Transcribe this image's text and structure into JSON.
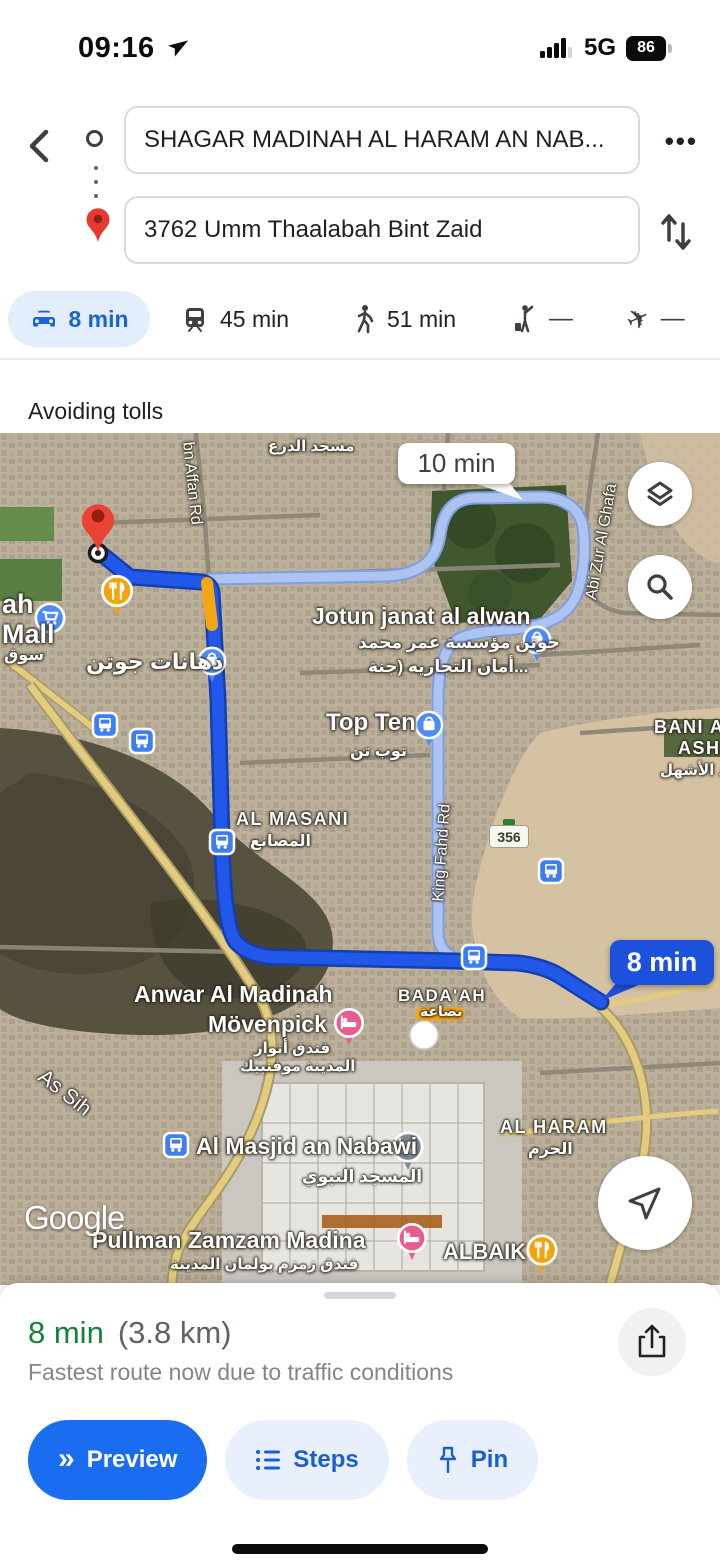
{
  "status_bar": {
    "time": "09:16",
    "network": "5G",
    "battery_percent": "86"
  },
  "nav": {
    "origin_value": "SHAGAR MADINAH AL HARAM AN NAB...",
    "destination_value": "3762 Umm Thaalabah Bint Zaid"
  },
  "icons": {
    "more_ellipsis": "•••",
    "preview_chevrons": "»",
    "plane_glyph": "✈"
  },
  "modes": [
    {
      "key": "drive",
      "time": "8 min",
      "selected": true
    },
    {
      "key": "transit",
      "time": "45 min",
      "selected": false
    },
    {
      "key": "walking",
      "time": "51 min",
      "selected": false
    },
    {
      "key": "ride",
      "time": "—",
      "selected": false
    },
    {
      "key": "flight",
      "time": "—",
      "selected": false
    }
  ],
  "route_options_note": "Avoiding tolls",
  "map": {
    "time_callouts": {
      "alternative": "10 min",
      "primary": "8 min"
    },
    "route_shield": "356",
    "attribution": "Google",
    "labels": {
      "masjid_aldira_ar": "مسجد الدرع",
      "ibn_affan_rd": "bn Affan Rd",
      "abi_zur_rd": "Abi Zur Al Ghafa",
      "mall_line1": "ah",
      "mall_line2": "Mall",
      "souq_ar": "سوق",
      "dahanat_jotun_ar": "دهانات جوتن",
      "jotun": "Jotun janat al alwan",
      "jotun_ar1": "جوتن مؤسسة عمر محمد",
      "jotun_ar2": "أمان التجاريه (جنة...",
      "top_ten": "Top Ten",
      "top_ten_ar": "توب تن",
      "al_masani": "AL MASANI",
      "al_masani_ar": "المصانع",
      "king_fahd_rd": "King Fahd Rd",
      "bani_line1": "BANI A",
      "bani_line2": "ASHH",
      "bani_ar": "عبد الأشهل",
      "badaah": "BADA'AH",
      "badaah_ar": "بضاعة",
      "anwar_line1": "Anwar Al Madinah",
      "anwar_line2": "Mövenpick",
      "anwar_ar1": "فندق أنوار",
      "anwar_ar2": "المدينة موفنبيك",
      "as_sih": "As Sih",
      "masjid_nabawi": "Al Masjid an Nabawi",
      "masjid_nabawi_ar": "المسجد النبوي",
      "al_haram": "AL HARAM",
      "al_haram_ar": "الحرم",
      "pullman": "Pullman Zamzam Madina",
      "pullman_ar": "فندق زمزم بولمان المدينة",
      "albaik": "ALBAIK"
    }
  },
  "bottom_sheet": {
    "duration": "8 min",
    "distance": "(3.8 km)",
    "note": "Fastest route now due to traffic conditions",
    "buttons": {
      "preview": "Preview",
      "steps": "Steps",
      "pin": "Pin"
    }
  },
  "colors": {
    "route_blue": "#2158ea",
    "alt_route_blue": "#adc4f2",
    "traffic_orange": "#f7a613",
    "callout_blue": "#1c51dc",
    "duration_green": "#188038",
    "accent_blue": "#1a6df0",
    "selected_pill_bg": "#e4edfc",
    "light_pill_bg": "#e9effc"
  }
}
